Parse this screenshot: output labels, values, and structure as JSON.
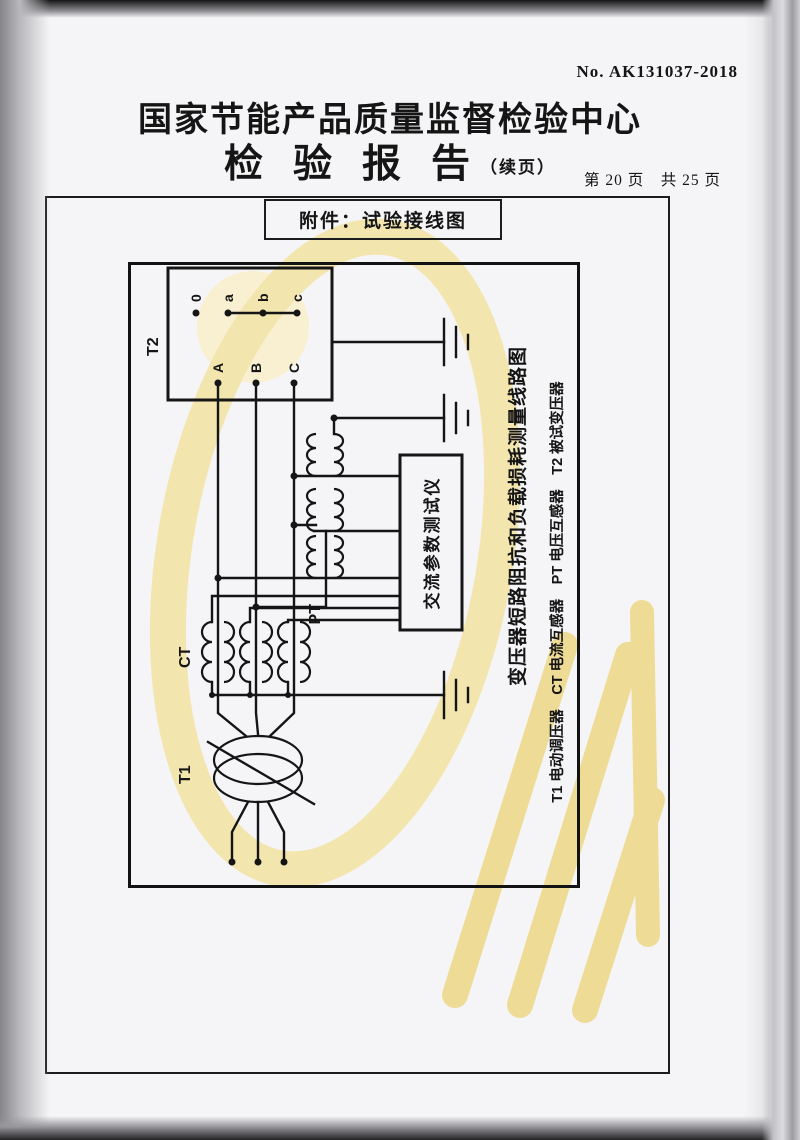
{
  "page": {
    "no_number": "No. AK131037-2018",
    "title": "国家节能产品质量监督检验中心",
    "report_title": "检验报告",
    "report_suffix": "（续页）",
    "page_info": "第 20 页　共 25 页",
    "attachment_label": "附件：试验接线图"
  },
  "diagram": {
    "labels": {
      "t1": "T1",
      "t2": "T2",
      "ct": "CT",
      "pt": "PT"
    },
    "t2_terminals": {
      "primary": [
        "A",
        "B",
        "C"
      ],
      "secondary": [
        "0",
        "a",
        "b",
        "c"
      ]
    },
    "tester_label": "交流参数测试仪",
    "caption_title": "变压器短路阻抗和负载损耗测量线路图",
    "caption_legend": "T1 电动调压器　CT 电流互感器　PT 电压互感器　T2 被试变压器"
  },
  "colors": {
    "ink": "#151515",
    "paper": "#f5f5f7",
    "watermark_yellow": "#f3e5ae",
    "watermark_deep": "#eedc96",
    "watermark_light": "#f9f0d2"
  }
}
